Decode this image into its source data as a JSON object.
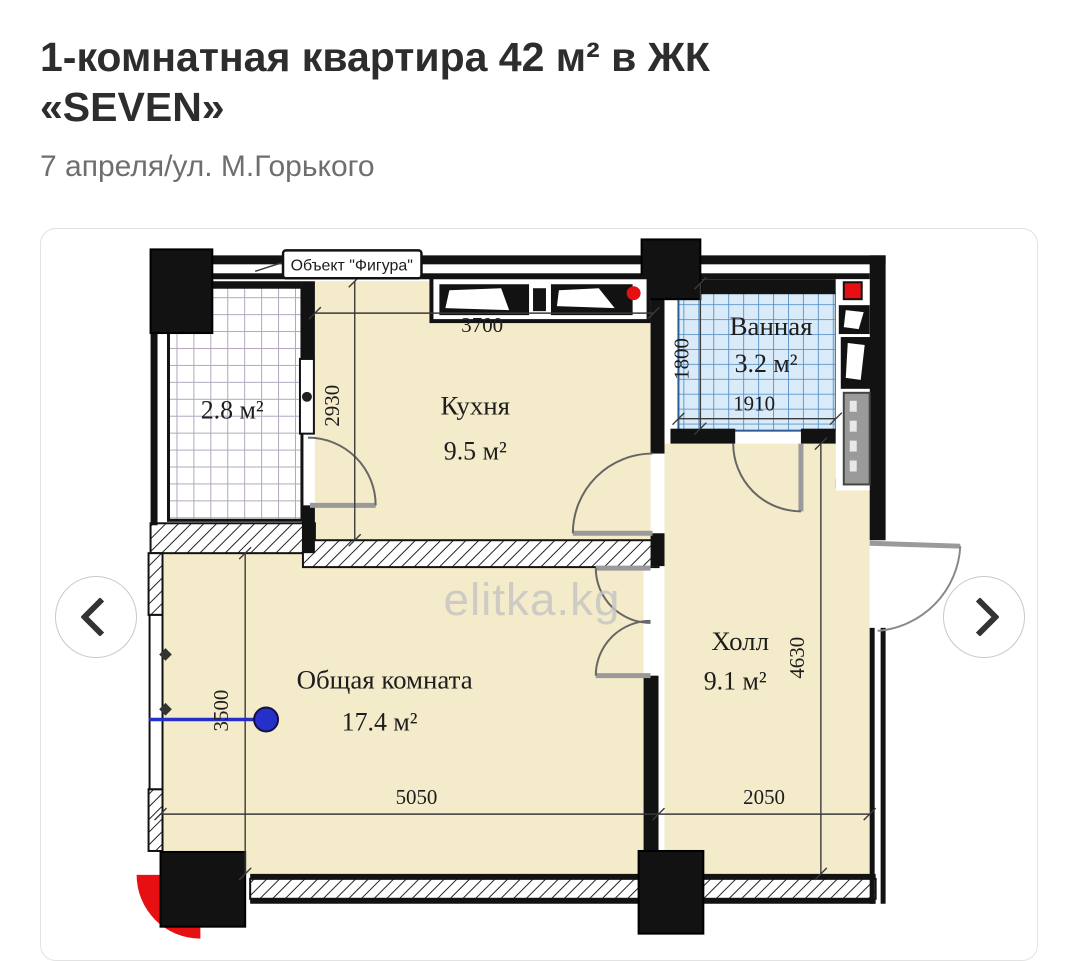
{
  "page": {
    "title_line1": "1-комнатная квартира 42 м² в ЖК",
    "title_line2": "«SEVEN»",
    "subtitle": "7 апреля/ул. М.Горького"
  },
  "gallery": {
    "prev_icon": "chevron-left",
    "next_icon": "chevron-right"
  },
  "plan": {
    "object_label": "Объект \"Фигура\"",
    "watermark": "elitka.kg",
    "rooms": {
      "kitchen": {
        "name": "Кухня",
        "area": "9.5 м²"
      },
      "bath": {
        "name": "Ванная",
        "area": "3.2 м²"
      },
      "hall": {
        "name": "Холл",
        "area": "9.1 м²"
      },
      "living": {
        "name": "Общая комната",
        "area": "17.4 м²"
      },
      "balcony": {
        "area": "2.8 м²"
      }
    },
    "dims": {
      "kitchen_w": "3700",
      "kitchen_h": "2930",
      "bath_h": "1800",
      "bath_w": "1910",
      "living_h": "3500",
      "living_w": "5050",
      "hall_w": "2050",
      "hall_h": "4630"
    },
    "colors": {
      "room_fill": "#f3ebc9",
      "tile_fill": "#d9eaf8",
      "tile_line": "#4a86c2",
      "balcony_grid": "#b3a6bd",
      "wall": "#121212",
      "red_marker": "#e60f12",
      "blue_marker": "#2430c8"
    }
  }
}
